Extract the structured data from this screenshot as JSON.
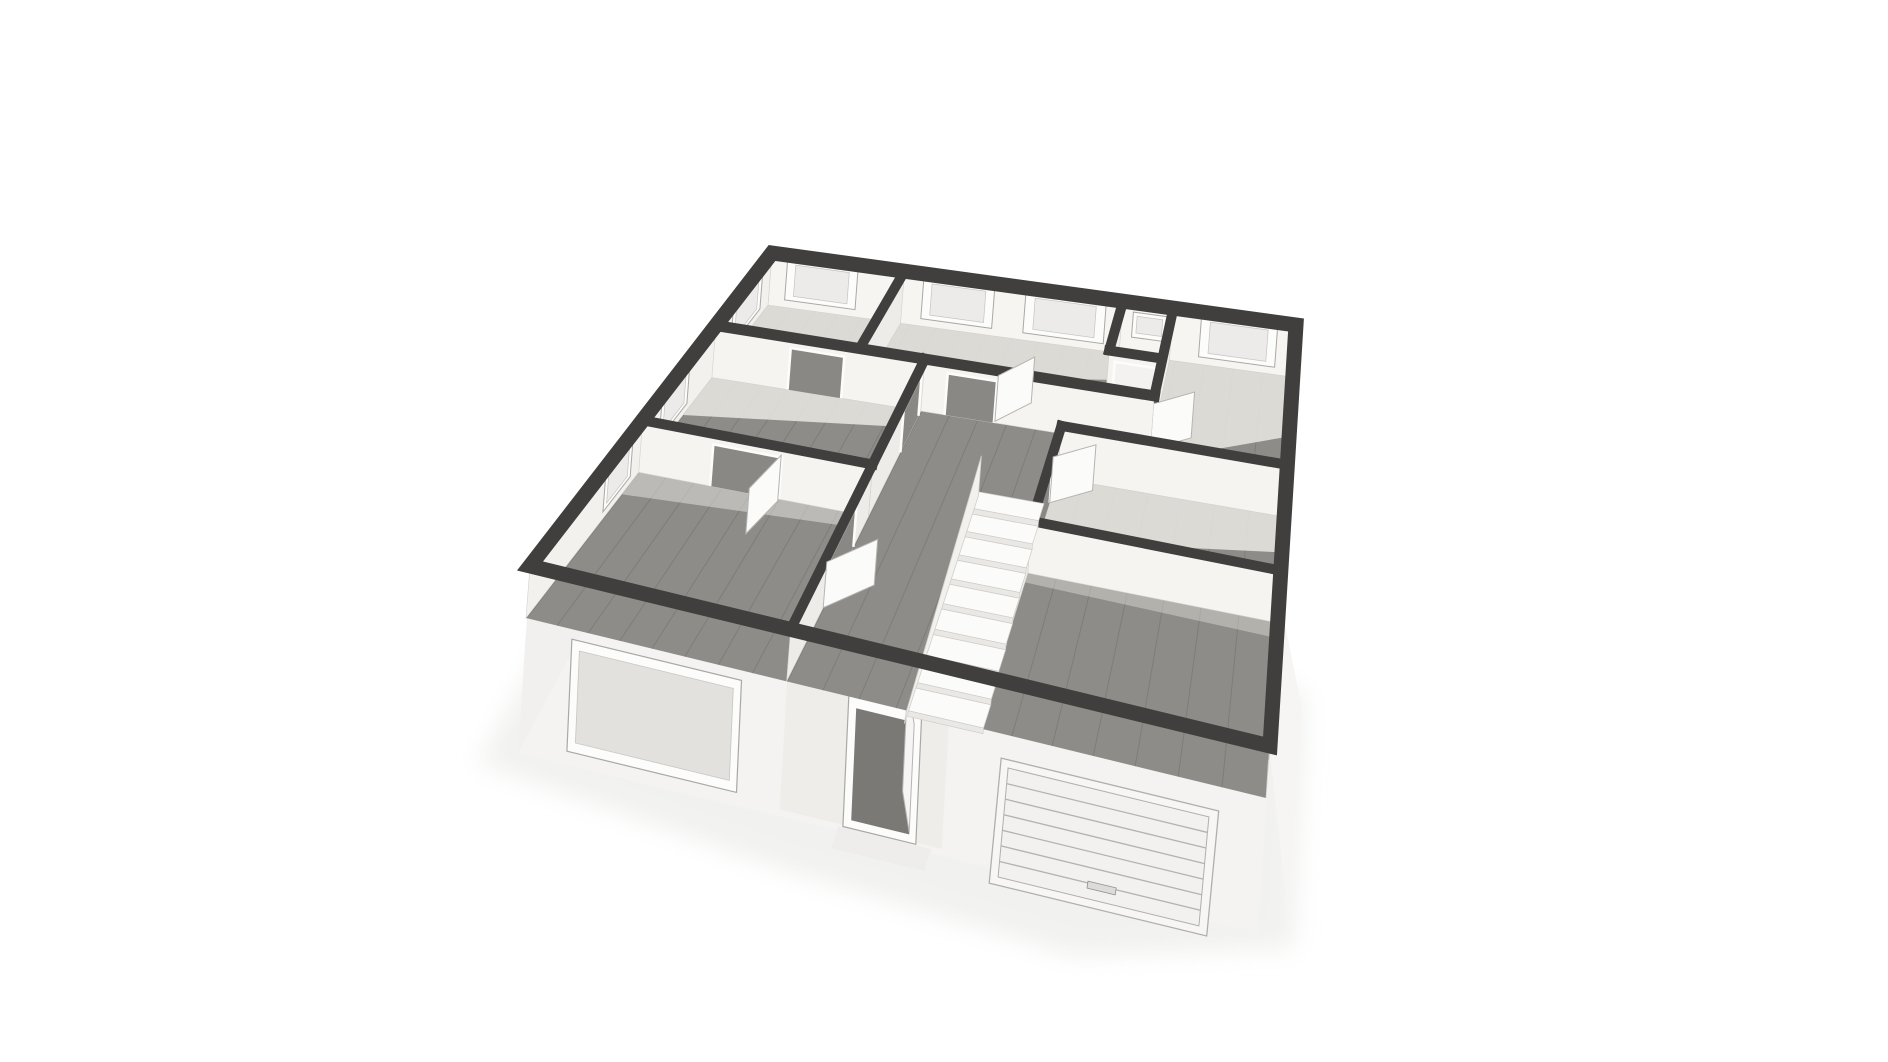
{
  "page": {
    "background": "#ffffff"
  },
  "viewport": {
    "width": 1888,
    "height": 1062,
    "label": "3D floor plan dollhouse view"
  },
  "scene": {
    "corners": {
      "n": [
        768,
        305
      ],
      "ne": [
        1292,
        377
      ],
      "e": [
        1266,
        798
      ],
      "w": [
        526,
        618
      ]
    },
    "wall_up": [
      4,
      -52
    ],
    "colors": {
      "cap": "#403f3e",
      "wood": "#8e8c88",
      "seam": "rgba(104,102,98,0.40)",
      "light_floor": "#eae8e3",
      "closet_floor": "#e9e7e3",
      "face_s": "#f5f4f1",
      "face_sw": "#f6f5f2",
      "face_se": "#f2f1ee",
      "face_w": "#f0efec",
      "face_e": "#edece9",
      "face_stroke": "#d2d1ce",
      "pane": "#ecebe9",
      "pane_dark": "#e2e1de",
      "frame": "#fcfcfb",
      "frame_stroke": "#a9a8a5",
      "door_gap": "#8a8884",
      "door_closed": "#f3f2f0",
      "leaf": "#fbfbf9",
      "leaf_stroke": "#b5b4b2",
      "skirt": "#f4f3f1",
      "skirt_shade": "#ecebe8",
      "shadow": "#e6e6e4",
      "tread": "#fbfbf9",
      "riser": "#e9e8e5",
      "stair_stroke": "#cccbc8",
      "stringer": "#f2f1ee",
      "slat": "#b3b2af",
      "garage_face": "#f2f1ef",
      "opening_dark": "#7b7976",
      "step": "#eeedeb"
    },
    "floors": [
      {
        "id": "floor-room-nw",
        "rect": [
          0,
          0,
          0.28,
          0.3
        ],
        "wood": true,
        "light": [
          [
            0,
            0
          ],
          [
            0.28,
            0
          ],
          [
            0.28,
            0.13
          ],
          [
            0.04,
            0.3
          ],
          [
            0,
            0.3
          ]
        ]
      },
      {
        "id": "floor-room-n",
        "rect": [
          0.28,
          0,
          0.7,
          0.3
        ],
        "wood": true,
        "light": [
          [
            0.28,
            0
          ],
          [
            0.7,
            0
          ],
          [
            0.7,
            0.1
          ],
          [
            0.28,
            0.21
          ]
        ]
      },
      {
        "id": "floor-closet",
        "rect": [
          0.7,
          0,
          0.79,
          0.18
        ],
        "wood": false
      },
      {
        "id": "floor-room-ne",
        "rect": [
          0.79,
          0,
          1,
          0.43
        ],
        "wood": true,
        "light": [
          [
            0.79,
            0
          ],
          [
            1,
            0
          ],
          [
            1,
            0.2
          ],
          [
            0.79,
            0.34
          ]
        ]
      },
      {
        "id": "floor-hall",
        "rect": [
          0.4,
          0.3,
          0.66,
          1
        ],
        "wood": true
      },
      {
        "id": "floor-corridor",
        "rect": [
          0.66,
          0.3,
          0.79,
          0.43
        ],
        "wood": true
      },
      {
        "id": "floor-closet-front",
        "rect": [
          0.7,
          0.18,
          0.79,
          0.3
        ],
        "wood": true
      },
      {
        "id": "floor-room-w",
        "rect": [
          0,
          0.3,
          0.4,
          0.62
        ],
        "wood": true,
        "light": [
          [
            0,
            0.3
          ],
          [
            0.4,
            0.3
          ],
          [
            0.4,
            0.355
          ],
          [
            0,
            0.435
          ]
        ]
      },
      {
        "id": "floor-room-e",
        "rect": [
          0.66,
          0.43,
          1,
          0.68
        ],
        "wood": true,
        "light": [
          [
            0.66,
            0.43
          ],
          [
            1,
            0.43
          ],
          [
            1,
            0.52
          ],
          [
            0.66,
            0.6
          ]
        ]
      },
      {
        "id": "floor-room-sw",
        "rect": [
          0,
          0.62,
          0.4,
          1
        ],
        "wood": true,
        "light": [
          [
            0,
            0.62
          ],
          [
            0.4,
            0.62
          ],
          [
            0.4,
            0.652
          ],
          [
            0,
            0.685
          ]
        ],
        "lightOp": 0.5
      },
      {
        "id": "floor-room-se",
        "rect": [
          0.66,
          0.68,
          1,
          1
        ],
        "wood": true,
        "light": [
          [
            0.66,
            0.68
          ],
          [
            1,
            0.68
          ],
          [
            1,
            0.712
          ],
          [
            0.66,
            0.702
          ]
        ],
        "lightOp": 0.4
      }
    ],
    "walls": [
      {
        "id": "wall-ne-exterior",
        "a": [
          0,
          0
        ],
        "b": [
          1,
          0
        ],
        "face": "sw",
        "cap": 0,
        "windows": [
          {
            "t": [
              0.035,
              0.185
            ]
          },
          {
            "t": [
              0.32,
              0.46
            ]
          },
          {
            "t": [
              0.52,
              0.67
            ]
          },
          {
            "t": [
              0.72,
              0.78
            ],
            "h": [
              0.34,
              0.82
            ]
          },
          {
            "t": [
              0.84,
              0.97
            ]
          }
        ]
      },
      {
        "id": "wall-nw-exterior",
        "a": [
          0,
          0
        ],
        "b": [
          0,
          1
        ],
        "face": "se",
        "cap": 0,
        "windows": [
          {
            "t": [
              0.05,
              0.21
            ]
          },
          {
            "t": [
              0.42,
              0.54
            ]
          },
          {
            "t": [
              0.655,
              0.755
            ]
          }
        ]
      },
      {
        "id": "wall-e-exterior",
        "a": [
          1,
          0
        ],
        "b": [
          1,
          1
        ],
        "face": "w",
        "cap": 0,
        "windows": [
          {
            "t": [
              0.06,
              0.17
            ]
          },
          {
            "t": [
              0.23,
              0.34
            ]
          },
          {
            "t": [
              0.48,
              0.59
            ]
          },
          {
            "t": [
              0.73,
              0.82
            ]
          },
          {
            "t": [
              0.87,
              0.95
            ]
          }
        ]
      },
      {
        "id": "wall-room-divider-n",
        "a": [
          0.28,
          0
        ],
        "b": [
          0.28,
          0.3
        ],
        "face": "e",
        "cap": 10
      },
      {
        "id": "wall-closet-w",
        "a": [
          0.7,
          0
        ],
        "b": [
          0.7,
          0.18
        ],
        "face": "w",
        "cap": 10
      },
      {
        "id": "wall-closet-s",
        "a": [
          0.7,
          0.18
        ],
        "b": [
          0.79,
          0.18
        ],
        "face": "s",
        "cap": 10,
        "doors": [
          {
            "t": [
              0.12,
              0.88
            ],
            "closed": true
          }
        ]
      },
      {
        "id": "wall-corridor-e",
        "a": [
          0.79,
          0
        ],
        "b": [
          0.79,
          0.43
        ],
        "face": "w",
        "cap": 10,
        "doors": [
          {
            "t": [
              0.7,
              0.95
            ]
          }
        ],
        "leaves": [
          {
            "h": [
              0.79,
              0.305
            ],
            "t": [
              0.85,
              0.25
            ]
          }
        ]
      },
      {
        "id": "wall-top-strip",
        "a": [
          0,
          0.3
        ],
        "b": [
          0.79,
          0.3
        ],
        "face": "s",
        "cap": 11,
        "doors": [
          {
            "t": [
              0.19,
              0.32
            ]
          },
          {
            "t": [
              0.56,
              0.67
            ]
          }
        ],
        "leaves": [
          {
            "h": [
              0.53,
              0.295
            ],
            "t": [
              0.578,
              0.218
            ]
          }
        ]
      },
      {
        "id": "wall-ne-room-s",
        "a": [
          0.66,
          0.43
        ],
        "b": [
          1,
          0.43
        ],
        "face": "s",
        "cap": 10
      },
      {
        "id": "wall-hall-w-mid",
        "a": [
          0.4,
          0.3
        ],
        "b": [
          0.4,
          0.62
        ],
        "face": "e",
        "cap": 10,
        "doors": [
          {
            "t": [
              0.05,
              0.42
            ]
          }
        ]
      },
      {
        "id": "wall-hall-e-mid",
        "a": [
          0.66,
          0.43
        ],
        "b": [
          0.66,
          0.68
        ],
        "face": "w",
        "cap": 10,
        "doors": [
          {
            "t": [
              0.28,
              0.8
            ]
          }
        ],
        "leaves": [
          {
            "h": [
              0.66,
              0.5
            ],
            "t": [
              0.718,
              0.448
            ]
          }
        ]
      },
      {
        "id": "wall-w-rooms-divider",
        "a": [
          0,
          0.62
        ],
        "b": [
          0.4,
          0.62
        ],
        "face": "s",
        "cap": 10,
        "doors": [
          {
            "t": [
              0.325,
              0.625
            ]
          }
        ],
        "leaves": [
          {
            "h": [
              0.25,
              0.625
            ],
            "t": [
              0.232,
              0.72
            ]
          }
        ]
      },
      {
        "id": "wall-se-room-n",
        "a": [
          0.66,
          0.68
        ],
        "b": [
          1,
          0.68
        ],
        "face": "s",
        "cap": 10
      },
      {
        "id": "wall-hall-w-s",
        "a": [
          0.4,
          0.62
        ],
        "b": [
          0.4,
          1
        ],
        "face": "e",
        "cap": 10,
        "doors": [
          {
            "t": [
              0.21,
              0.58
            ]
          }
        ],
        "leaves": [
          {
            "h": [
              0.4,
              0.845
            ],
            "t": [
              0.455,
              0.775
            ]
          }
        ]
      },
      {
        "id": "wall-hall-e-s",
        "a": [
          0.66,
          0.68
        ],
        "b": [
          0.66,
          1
        ],
        "face": "w",
        "cap": 10,
        "doors": [
          {
            "t": [
              0.5,
              0.84
            ]
          }
        ]
      }
    ],
    "stairs": {
      "u1": 0.548,
      "u2": 0.652,
      "v0": 0.505,
      "dv": 0.046,
      "steps": 9,
      "dropX": -0.45,
      "dropY": 5.6
    },
    "facade": {
      "front_door": {
        "t": [
          0.487,
          0.585
        ]
      },
      "big_window": {
        "t": [
          0.075,
          0.335
        ]
      },
      "garage": {
        "t": [
          0.685,
          0.945
        ],
        "slats": 7
      }
    }
  }
}
